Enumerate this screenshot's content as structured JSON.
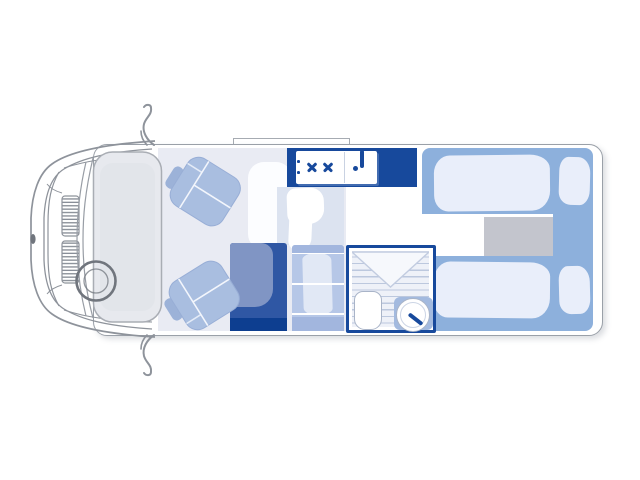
{
  "meta": {
    "description": "Top-down floor plan diagram of a motorhome / campervan layout",
    "view": "top-down",
    "vehicle_front": "left",
    "visible_text": ""
  },
  "colors": {
    "outline": "#9aa0a8",
    "cab-line": "#8e939b",
    "navy": "#17499c",
    "wardrobe-base": "#2f57a4",
    "wardrobe-door": "#8095c4",
    "wardrobe-dark": "#0d3e90",
    "bed-blue": "#8db0dc",
    "bedding": "#e9eefa",
    "chest-gray": "#c3c5cd",
    "seat-blue": "#a9bee0",
    "seat-seam": "#f3f6fc",
    "bench-base": "#b6c7e7",
    "bench-trim": "#a2b6de",
    "bench-cushion": "#e1e8f5",
    "floor-tint": "#e9ebf3",
    "cab-fill": "#e7e9ee",
    "cab-inner": "#e2e5ea",
    "dinette": "#dce3f0",
    "shower-bg": "#eef1f8",
    "shower-line": "#bcc8de",
    "fixture-line": "#a9b4c8",
    "counter-blue": "#a3badf"
  },
  "zones": {
    "cab": {
      "name": "driver-cab",
      "items": [
        "front-bumper",
        "radiator-grille",
        "windscreen",
        "steering-wheel",
        "wing-mirror-top",
        "wing-mirror-bottom",
        "swivel-seat-top",
        "swivel-seat-bottom"
      ]
    },
    "kitchen": {
      "name": "kitchen-galley",
      "items": [
        "worktop",
        "two-burner-hob",
        "sink",
        "tap",
        "control-knobs"
      ]
    },
    "lounge": {
      "name": "dinette-lounge",
      "items": [
        "side-seat",
        "table",
        "bench-seat",
        "wardrobe"
      ]
    },
    "bathroom": {
      "name": "washroom",
      "items": [
        "shower-tray",
        "shower-curtain-flap",
        "toilet",
        "washbasin",
        "basin-tap",
        "vanity-counter"
      ]
    },
    "bedroom": {
      "name": "rear-twin-beds",
      "items": [
        "single-bed-top",
        "single-bed-bottom",
        "duvet-top",
        "duvet-bottom",
        "pillow-top",
        "pillow-bottom",
        "center-chest",
        "walkway"
      ]
    },
    "exterior": {
      "items": [
        "awning-rail",
        "body-shell"
      ]
    }
  }
}
